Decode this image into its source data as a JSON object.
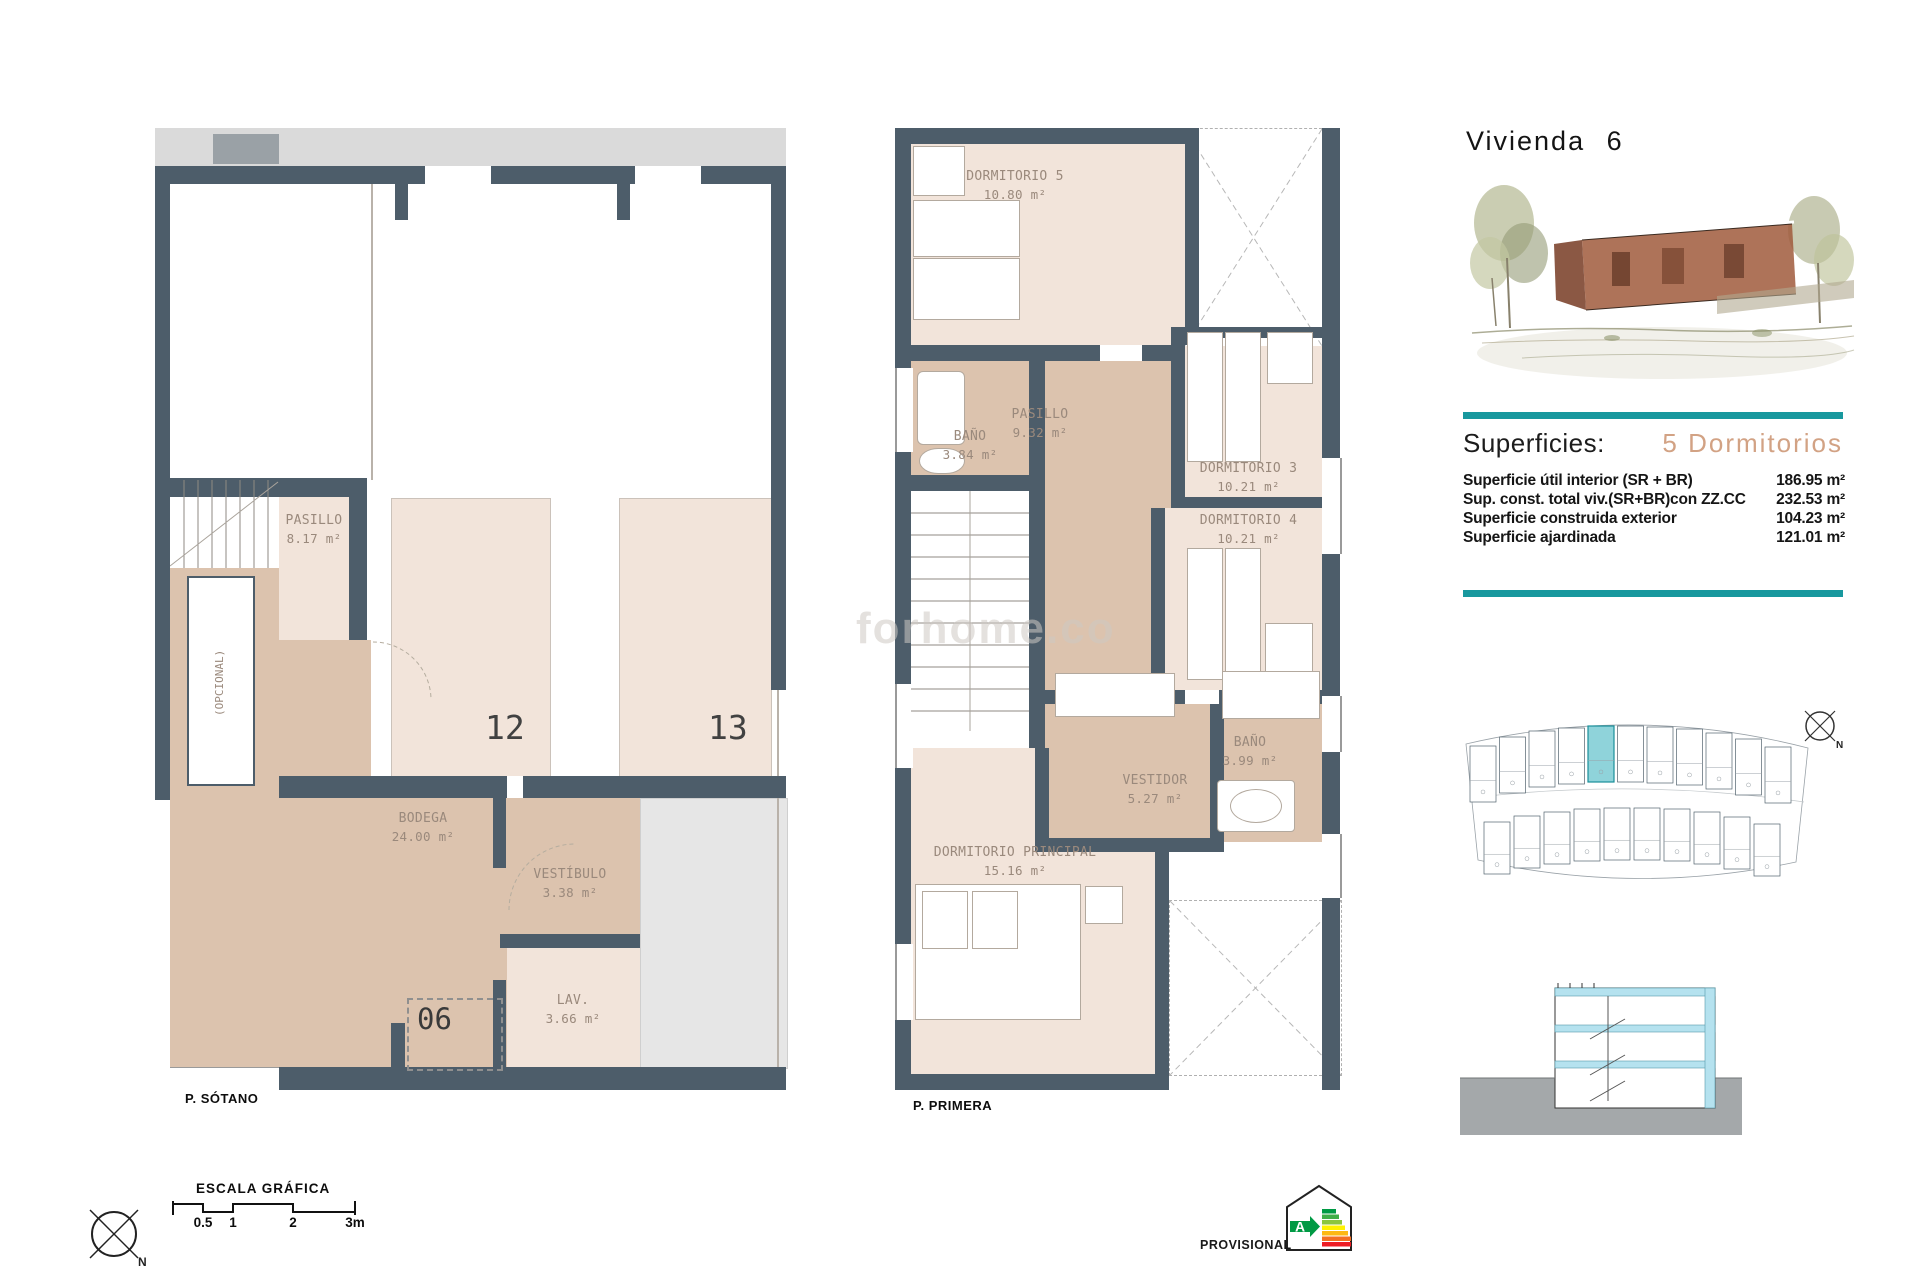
{
  "title": "Vivienda 6",
  "watermark": "forhome.co",
  "plan_sotano": {
    "name": "P. SÓTANO",
    "pasillo_label": "PASILLO",
    "pasillo_area": "8.17 m²",
    "opcional_label": "(OPCIONAL)",
    "bodega_label": "BODEGA",
    "bodega_area": "24.00 m²",
    "vestibulo_label": "VESTÍBULO",
    "vestibulo_area": "3.38 m²",
    "lav_label": "LAV.",
    "lav_area": "3.66 m²",
    "room12": "12",
    "room13": "13",
    "unit06": "06"
  },
  "plan_primera": {
    "name": "P. PRIMERA",
    "dorm5_label": "DORMITORIO 5",
    "dorm5_area": "10.80 m²",
    "bano1_label": "BAÑO",
    "bano1_area": "3.84 m²",
    "pasillo_label": "PASILLO",
    "pasillo_area": "9.32 m²",
    "dorm3_label": "DORMITORIO 3",
    "dorm3_area": "10.21 m²",
    "dorm4_label": "DORMITORIO 4",
    "dorm4_area": "10.21 m²",
    "bano2_label": "BAÑO",
    "bano2_area": "3.99 m²",
    "vestidor_label": "VESTIDOR",
    "vestidor_area": "5.27 m²",
    "dormp_label": "DORMITORIO PRINCIPAL",
    "dormp_area": "15.16 m²"
  },
  "info": {
    "superficies_label": "Superficies:",
    "type_label": "5 Dormitorios",
    "rows": [
      {
        "label": "Superficie útil interior (SR + BR)",
        "value": "186.95 m²"
      },
      {
        "label": "Sup. const. total viv.(SR+BR)con ZZ.CC",
        "value": "232.53 m²"
      },
      {
        "label": "Superficie construida exterior",
        "value": "104.23 m²"
      },
      {
        "label": "Superficie ajardinada",
        "value": "121.01 m²"
      }
    ]
  },
  "footer": {
    "scale_title": "ESCALA GRÁFICA",
    "ticks": [
      "0.5",
      "1",
      "2",
      "3m"
    ],
    "provisional": "PROVISIONAL",
    "energy_letter": "A",
    "north": "N"
  },
  "colors": {
    "teal": "#18989e",
    "accent": "#d2a284",
    "wall": "#4d5d6a"
  }
}
